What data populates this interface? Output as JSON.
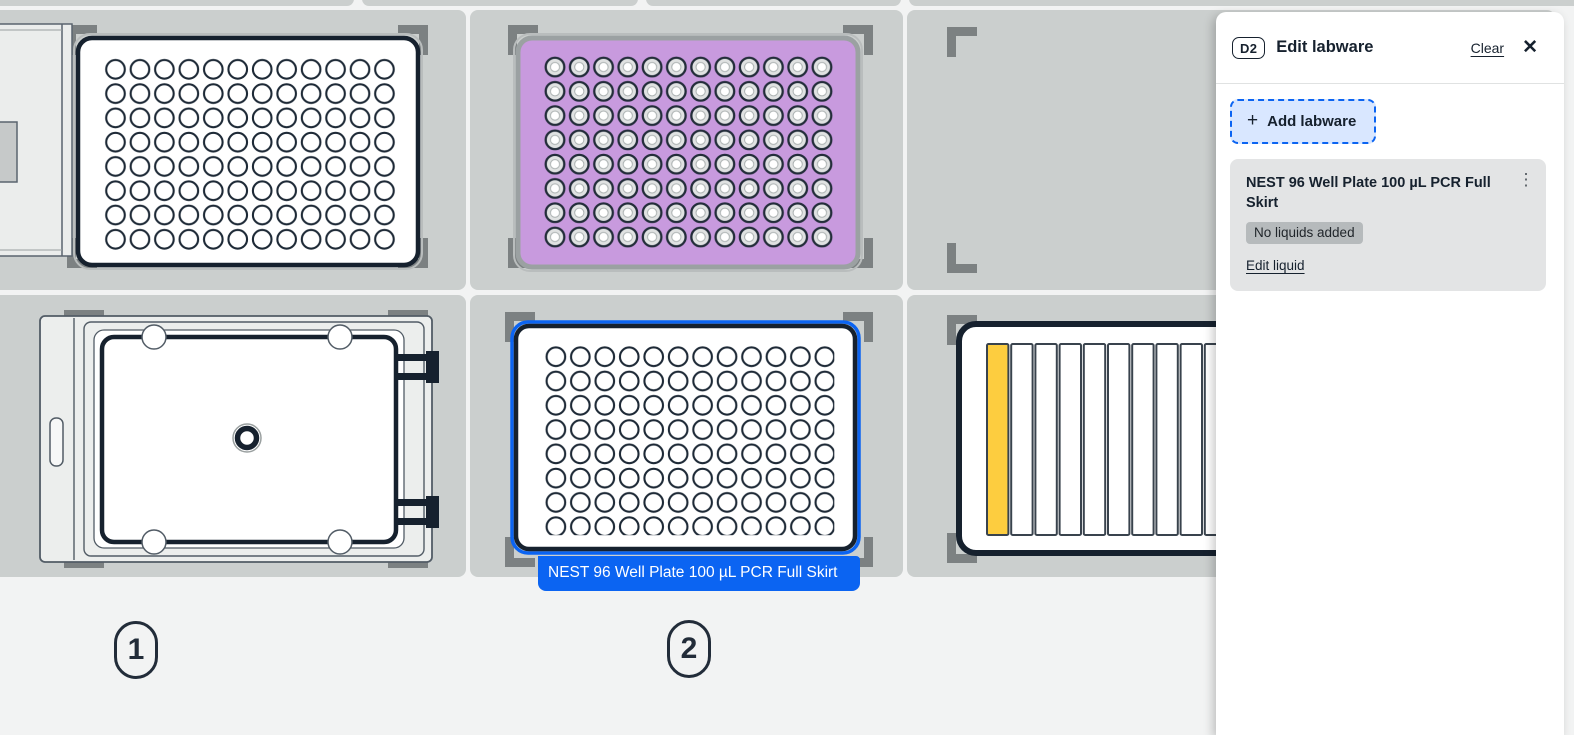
{
  "colors": {
    "accent_blue": "#0b64f2",
    "navy_outline": "#16212e",
    "slot_gray": "#cbcfce",
    "bracket_gray": "#7c8182",
    "plate_purple": "#c89ade",
    "reservoir_yellow": "#fdcd3f",
    "add_button_bg": "#d9e7ff",
    "card_bg": "#e3e4e5",
    "status_badge_bg": "#b6babc"
  },
  "deck": {
    "slot_numbers": [
      "1",
      "2"
    ],
    "selected_labware_label": "NEST 96 Well Plate 100 µL PCR Full Skirt"
  },
  "panel": {
    "slot_badge": "D2",
    "title": "Edit labware",
    "clear_label": "Clear",
    "add_labware_label": "Add labware",
    "card": {
      "name": "NEST 96 Well Plate 100 µL PCR Full Skirt",
      "status": "No liquids added",
      "edit_liquid_label": "Edit liquid"
    },
    "icons": {
      "close": "✕",
      "plus": "+",
      "kebab": "⋮"
    }
  }
}
